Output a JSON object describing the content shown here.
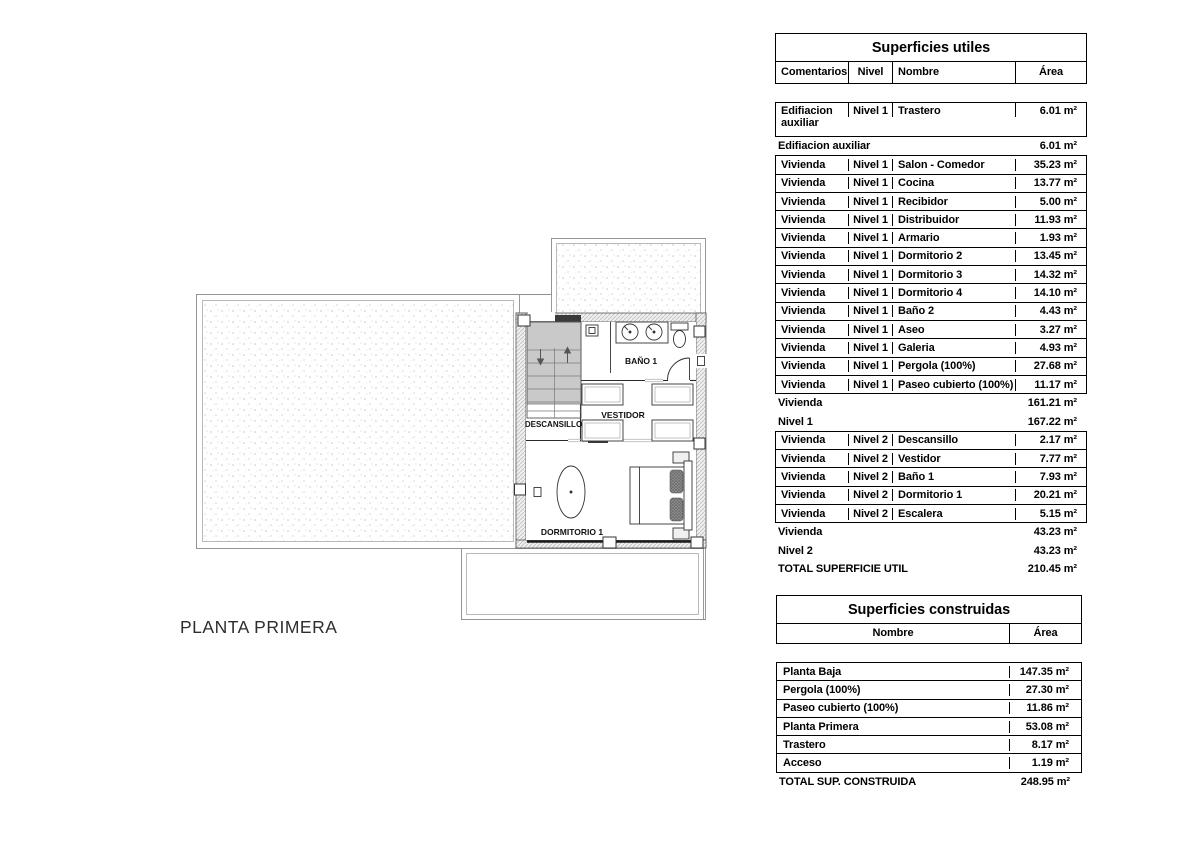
{
  "plan": {
    "title": "PLANTA PRIMERA",
    "labels": {
      "landing": "DESCANSILLO",
      "dressing": "VESTIDOR",
      "bath": "BAÑO 1",
      "bedroom": "DORMITORIO 1"
    }
  },
  "superficies_utiles": {
    "title": "Superficies utiles",
    "columns": [
      "Comentarios",
      "Nivel",
      "Nombre",
      "Área"
    ],
    "rows": [
      {
        "kind": "data2",
        "cells": [
          "Edifiacion auxiliar",
          "Nivel 1",
          "Trastero",
          "6.01 m²"
        ]
      },
      {
        "kind": "sum",
        "label": "Edifiacion auxiliar",
        "value": "6.01 m²"
      },
      {
        "kind": "data",
        "cells": [
          "Vivienda",
          "Nivel 1",
          "Salon - Comedor",
          "35.23 m²"
        ]
      },
      {
        "kind": "data",
        "cells": [
          "Vivienda",
          "Nivel 1",
          "Cocina",
          "13.77 m²"
        ]
      },
      {
        "kind": "data",
        "cells": [
          "Vivienda",
          "Nivel 1",
          "Recibidor",
          "5.00 m²"
        ]
      },
      {
        "kind": "data",
        "cells": [
          "Vivienda",
          "Nivel 1",
          "Distribuidor",
          "11.93 m²"
        ]
      },
      {
        "kind": "data",
        "cells": [
          "Vivienda",
          "Nivel 1",
          "Armario",
          "1.93 m²"
        ]
      },
      {
        "kind": "data",
        "cells": [
          "Vivienda",
          "Nivel 1",
          "Dormitorio 2",
          "13.45 m²"
        ]
      },
      {
        "kind": "data",
        "cells": [
          "Vivienda",
          "Nivel 1",
          "Dormitorio 3",
          "14.32 m²"
        ]
      },
      {
        "kind": "data",
        "cells": [
          "Vivienda",
          "Nivel 1",
          "Dormitorio 4",
          "14.10 m²"
        ]
      },
      {
        "kind": "data",
        "cells": [
          "Vivienda",
          "Nivel 1",
          "Baño 2",
          "4.43 m²"
        ]
      },
      {
        "kind": "data",
        "cells": [
          "Vivienda",
          "Nivel 1",
          "Aseo",
          "3.27 m²"
        ]
      },
      {
        "kind": "data",
        "cells": [
          "Vivienda",
          "Nivel 1",
          "Galeria",
          "4.93 m²"
        ]
      },
      {
        "kind": "data",
        "cells": [
          "Vivienda",
          "Nivel 1",
          "Pergola (100%)",
          "27.68 m²"
        ]
      },
      {
        "kind": "data",
        "cells": [
          "Vivienda",
          "Nivel 1",
          "Paseo cubierto (100%)",
          "11.17 m²"
        ]
      },
      {
        "kind": "sum",
        "label": "Vivienda",
        "value": "161.21 m²"
      },
      {
        "kind": "sum",
        "label": "Nivel 1",
        "value": "167.22 m²"
      },
      {
        "kind": "data",
        "cells": [
          "Vivienda",
          "Nivel 2",
          "Descansillo",
          "2.17 m²"
        ]
      },
      {
        "kind": "data",
        "cells": [
          "Vivienda",
          "Nivel 2",
          "Vestidor",
          "7.77 m²"
        ]
      },
      {
        "kind": "data",
        "cells": [
          "Vivienda",
          "Nivel 2",
          "Baño 1",
          "7.93 m²"
        ]
      },
      {
        "kind": "data",
        "cells": [
          "Vivienda",
          "Nivel 2",
          "Dormitorio 1",
          "20.21 m²"
        ]
      },
      {
        "kind": "data",
        "cells": [
          "Vivienda",
          "Nivel 2",
          "Escalera",
          "5.15 m²"
        ]
      },
      {
        "kind": "sum",
        "label": "Vivienda",
        "value": "43.23 m²"
      },
      {
        "kind": "sum",
        "label": "Nivel 2",
        "value": "43.23 m²"
      },
      {
        "kind": "sum",
        "label": "TOTAL SUPERFICIE UTIL",
        "value": "210.45 m²"
      }
    ]
  },
  "superficies_construidas": {
    "title": "Superficies construidas",
    "columns": [
      "Nombre",
      "Área"
    ],
    "rows": [
      {
        "kind": "data",
        "cells": [
          "Planta Baja",
          "147.35 m²"
        ]
      },
      {
        "kind": "data",
        "cells": [
          "Pergola (100%)",
          "27.30 m²"
        ]
      },
      {
        "kind": "data",
        "cells": [
          "Paseo cubierto (100%)",
          "11.86 m²"
        ]
      },
      {
        "kind": "data",
        "cells": [
          "Planta Primera",
          "53.08 m²"
        ]
      },
      {
        "kind": "data",
        "cells": [
          "Trastero",
          "8.17 m²"
        ]
      },
      {
        "kind": "data",
        "cells": [
          "Acceso",
          "1.19 m²"
        ]
      },
      {
        "kind": "sum",
        "label": "TOTAL SUP. CONSTRUIDA",
        "value": "248.95 m²"
      }
    ]
  }
}
